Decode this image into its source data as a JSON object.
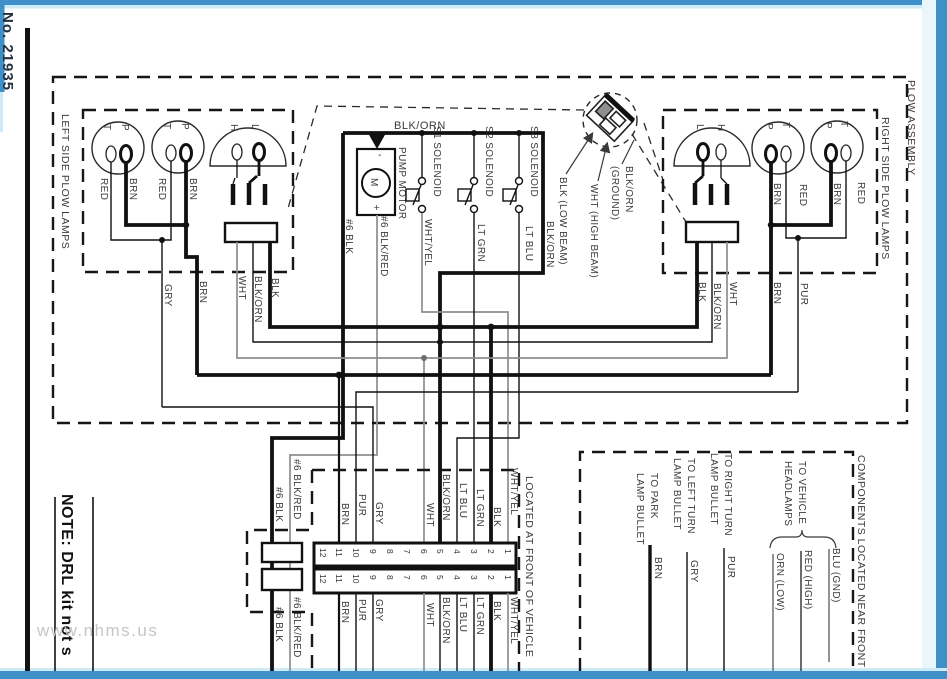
{
  "page": {
    "doc_number": "No. 21935",
    "note": "NOTE: DRL kit not s",
    "watermark": "www.nhms.us"
  },
  "frames": {
    "plow_assembly": "PLOW ASSEMBLY",
    "left_lamps": "LEFT SIDE PLOW LAMPS",
    "right_lamps": "RIGHT SIDE PLOW LAMPS",
    "located_front": "LOCATED AT FRONT OF VEHICLE",
    "components_front": "COMPONENTS LOCATED NEAR FRONT"
  },
  "components": {
    "pump_motor": "PUMP MOTOR",
    "motor_m": "M",
    "motor_plus": "+",
    "motor_minus": "-",
    "s1": "S1 SOLENOID",
    "s2": "S2 SOLENOID",
    "s3": "S3 SOLENOID"
  },
  "lamp_pins": {
    "t": "T",
    "p": "P",
    "h": "H",
    "l": "L"
  },
  "w": {
    "red": "RED",
    "brn": "BRN",
    "gry": "GRY",
    "pur": "PUR",
    "wht": "WHT",
    "blk": "BLK",
    "blk_orn": "BLK/ORN",
    "wht_yel": "WHT/YEL",
    "lt_grn": "LT GRN",
    "lt_blu": "LT BLU",
    "n6_blk": "#6 BLK",
    "n6_blk_red": "#6 BLK/RED",
    "orn_low": "ORN (LOW)",
    "red_high": "RED (HIGH)",
    "blu_gnd": "BLU (GND)"
  },
  "callout": {
    "low": "BLK (LOW BEAM)",
    "high": "WHT (HIGH BEAM)",
    "ground_1": "BLK/ORN",
    "ground_2": "(GROUND)"
  },
  "connector": {
    "pins": [
      "12",
      "11",
      "10",
      "9",
      "8",
      "7",
      "6",
      "5",
      "4",
      "3",
      "2",
      "1"
    ]
  },
  "bullets": {
    "park_1": "TO PARK",
    "park_2": "LAMP BULLET",
    "left_1": "TO LEFT TURN",
    "left_2": "LAMP BULLET",
    "right_1": "TO RIGHT TURN",
    "right_2": "LAMP BULLET",
    "veh_1": "TO VEHICLE",
    "veh_2": "HEADLAMPS"
  },
  "colors": {
    "border_blue": "#3f90c8",
    "border_fade": "#cdeaf8",
    "ink": "#1a1a1a"
  }
}
